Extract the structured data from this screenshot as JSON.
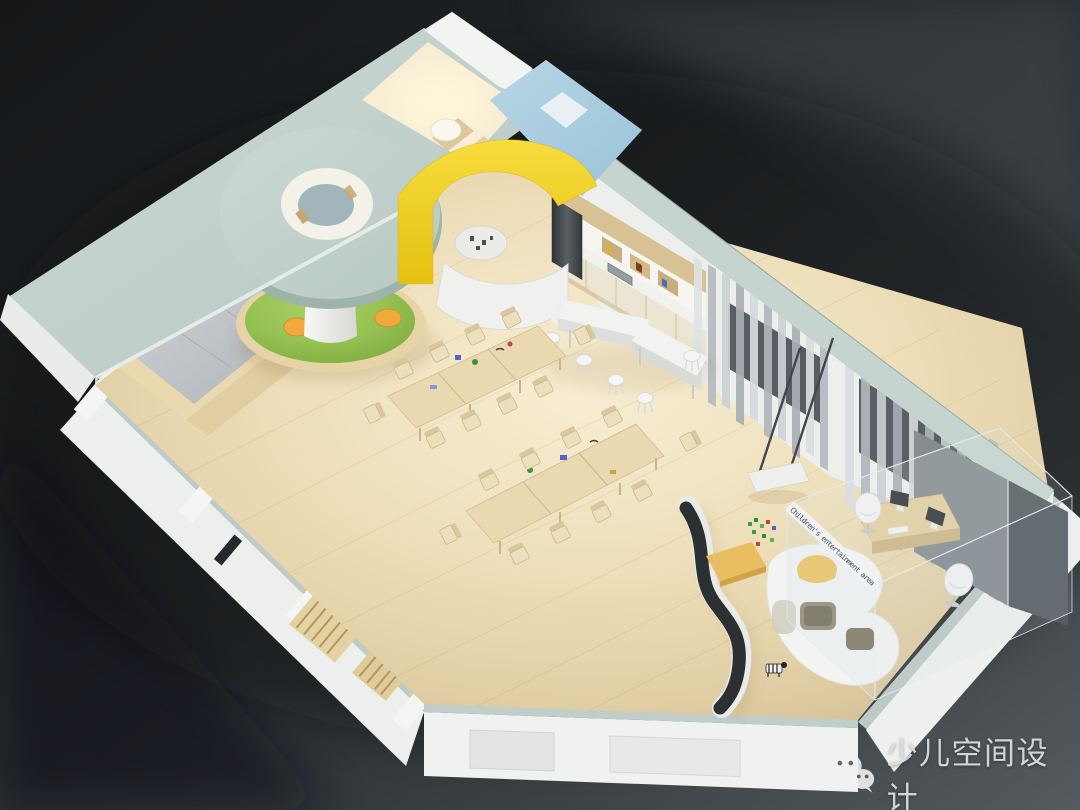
{
  "scene": {
    "description": "Axonometric 3D cutaway rendering of a children's space interior: circular play mound under a round canopy skylight, reading platform with picture books, rows of kids activity tables and chairs, kitchen with bar counter and stools, gray curtained windows, hanging swing, curved black slide wall, white play shelf and a glass-walled office corner.",
    "glass_partition_label": "Children's entertainment area"
  },
  "watermark": {
    "icon": "wechat-icon",
    "text": "少儿空间设计"
  },
  "palette": {
    "background_dark": "#17191b",
    "background_light": "#515759",
    "ceiling_sage": "#c2d1cc",
    "floor_wood": "#eedfba",
    "accent_green": "#8fbc4d",
    "accent_yellow": "#f0d01e",
    "accent_blue": "#a9cde0",
    "accent_orange": "#f2a93b",
    "curtain_gray": "#b7bcc0",
    "exterior_white": "#eff1f0",
    "slide_black": "#2c3033",
    "glass_label_ink": "#44506b",
    "watermark_text_color": "#dcdfe1"
  }
}
